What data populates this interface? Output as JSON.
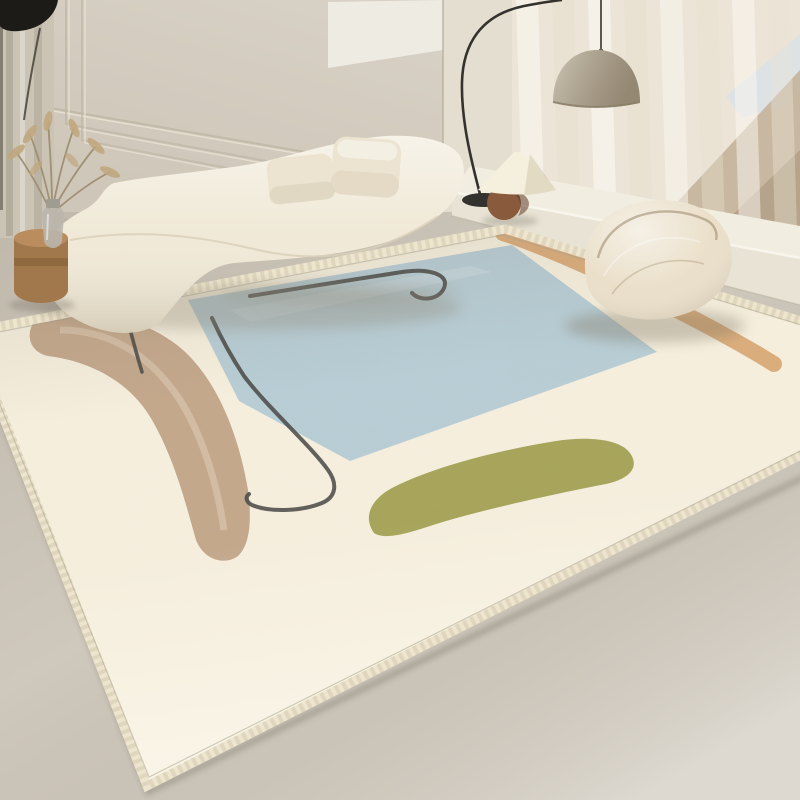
{
  "scene": {
    "title": "Minimalist living room with abstract beige area rug",
    "kind": "interior product photograph",
    "objects": [
      {
        "id": "wall-paneling",
        "label": "Beige wall with stepped panel molding"
      },
      {
        "id": "left-drape",
        "label": "Left curtain drape with dark sconce"
      },
      {
        "id": "wall-art-panel",
        "label": "White recessed wall panel"
      },
      {
        "id": "sheer-curtains",
        "label": "Sheer curtains with dune view window"
      },
      {
        "id": "window-platform",
        "label": "White window platform bench"
      },
      {
        "id": "arc-floor-lamp",
        "label": "Black arc floor lamp with dome shade"
      },
      {
        "id": "table-lamp",
        "label": "Cone-shade table lamp with brown ball base"
      },
      {
        "id": "curved-sofa",
        "label": "Cream curved boucle sofa"
      },
      {
        "id": "cushions",
        "label": "Two cream cushions"
      },
      {
        "id": "plant-stool",
        "label": "Wood stool with dried-grass vase"
      },
      {
        "id": "knit-pouf",
        "label": "Cream knitted pouf chair"
      },
      {
        "id": "area-rug",
        "label": "Ivory rug with blue square, tan arc, green blob, orange strokes and black line motifs"
      }
    ]
  },
  "palette": {
    "wall": "#d7cfc2",
    "wall_line": "#bfb6a5",
    "art_panel": "#edebe2",
    "column": "#e4ded1",
    "curtain": "#ece5d7",
    "window_dune": "#c2b098",
    "window_dune_dark": "#ac9a82",
    "window_sky": "#dde2e4",
    "platform_top": "#f1ede0",
    "platform_front": "#e8e3d4",
    "floor": "#cfc8bc",
    "drape": "#cbc4b5",
    "black_accent": "#1d1b17",
    "lamp_metal": "#34322e",
    "dome_shade": "#b2a58d",
    "table_lamp_shade": "#f5efde",
    "table_lamp_base": "#8a5a3d",
    "rug_ground": "#f5eedd",
    "rug_border": "#eee5cf",
    "rug_blue": "#b7ccd4",
    "rug_tan": "#c3a78b",
    "rug_green": "#a6a359",
    "rug_orange": "#d8a875",
    "rug_line": "#4a4a47",
    "sofa": "#f0e9d7",
    "pillow": "#ece4d1",
    "pouf": "#eadfc9",
    "stool": "#a1784c",
    "stool_top": "#bb8d5e",
    "vase": "#b9b6ac",
    "plant_stem": "#9c8b6d",
    "plant_foliage": "#c0a87f"
  }
}
